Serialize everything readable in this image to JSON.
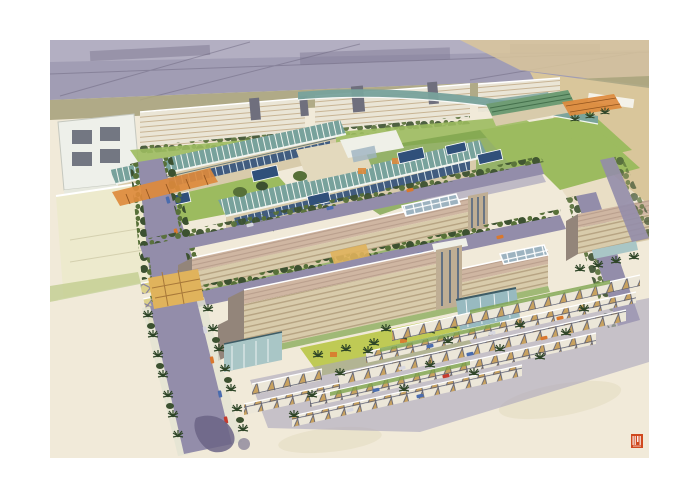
{
  "artwork": {
    "alt": "Watercolor aerial perspective rendering of a corporate campus master plan: curved teal glass-roofed buildings, long beige striped office slabs, palm-lined streets, rows of sawtooth parking canopies, freeway corridor at top, desert sand foreground",
    "stamp": {
      "glyph": "artist monogram seal",
      "color": "#d0491f"
    }
  },
  "palette": {
    "paper": "#ffffff",
    "sand": "#f1ead9",
    "sandShade": "#e5dcc1",
    "highway": "#a19db4",
    "highwayDark": "#817b95",
    "highwayLight": "#bab6c7",
    "laneLine": "#6e6880",
    "desertTan": "#d9c69b",
    "oliveField": "#a9a37d",
    "indWall": "#eae5d6",
    "indStripe": "#c8b494",
    "indDark": "#6f6f7d",
    "grass": "#9cbb5f",
    "grassDark": "#7ea44c",
    "lawnYellow": "#bfca55",
    "paleGreen": "#c2cd90",
    "treeDark": "#3c5130",
    "treeMid": "#577038",
    "palmDark": "#2e4527",
    "glassTeal": "#78a29c",
    "glassRib": "#f2f5f0",
    "eaveDark": "#3e5c66",
    "roofGreen": "#6f9c74",
    "roofGreenLine": "#44704c",
    "wallBeige": "#d8cbab",
    "wallStripe": "#b6a382",
    "slabRoof": "#cfb6a2",
    "slabRoofLine": "#b89d8b",
    "slabShade": "#93857a",
    "towerTan": "#bfae94",
    "windowBlue": "#30507a",
    "mullion": "#cfe0ee",
    "skyGrid": "#9db3c0",
    "road": "#938daa",
    "roadLight": "#aaa5bc",
    "sidewalk": "#e3e3d2",
    "canopyWhite": "#ece7d9",
    "canopyTan": "#c8a260",
    "canopyLine": "#565a70",
    "canopyYellow": "#ddd28b",
    "canopyXLine": "#837da0",
    "tealWing": "#a9c6c6",
    "pavilionBlue": "#98bac0",
    "paleBox": "#edeacd",
    "paleBoxShade": "#dcd8ba",
    "accentOrange": "#dd8a3c",
    "bridgeLine": "#93551f",
    "plazaYellow": "#e0b35c",
    "plazaLine": "#a8793a",
    "carBlue": "#4a6cae",
    "carOrange": "#d9782e",
    "carWhite": "#d8d8e0",
    "carRed": "#c53b2e",
    "splotch": "#6b6486",
    "whiteBldg": "#eef0ea",
    "whiteBldgWin": "#5e6370",
    "stampRed": "#d0491f"
  }
}
